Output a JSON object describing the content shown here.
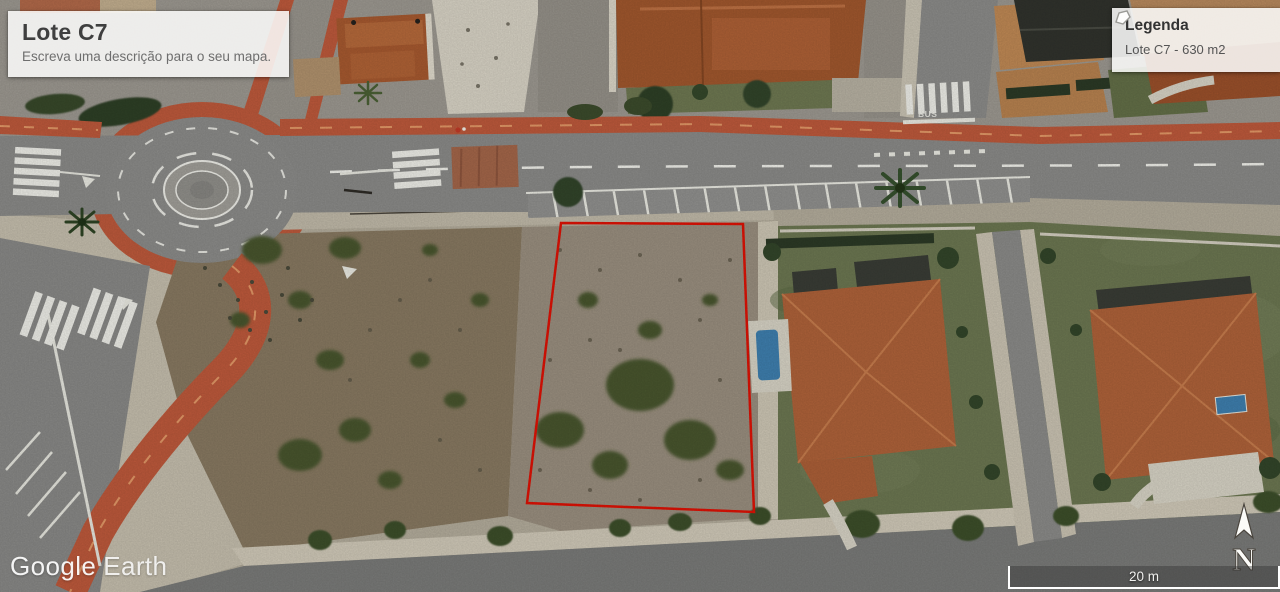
{
  "title_panel": {
    "title": "Lote C7",
    "subtitle": "Escreva uma descrição para o seu mapa."
  },
  "legend_panel": {
    "title": "Legenda",
    "items": [
      {
        "icon": "polygon-icon",
        "label": "Lote C7 - 630 m2"
      }
    ]
  },
  "watermark": {
    "google": "Google",
    "earth": "Earth"
  },
  "compass": {
    "label": "N"
  },
  "scale_bar": {
    "label": "20 m"
  },
  "road_markings": {
    "bus": "BUS"
  },
  "lot": {
    "name": "Lote C7",
    "area_m2": 630,
    "outline_points": "561,223 743,224 754,512 527,503"
  },
  "colors": {
    "lot_outline": "#e01205",
    "bike_lane": "#bf5a3c",
    "asphalt": "#8c8c8a",
    "lawn": "#6d7852",
    "dirt_dark": "#897a62",
    "dirt_light": "#9b9080",
    "roof_terracotta": "#b0633a"
  }
}
